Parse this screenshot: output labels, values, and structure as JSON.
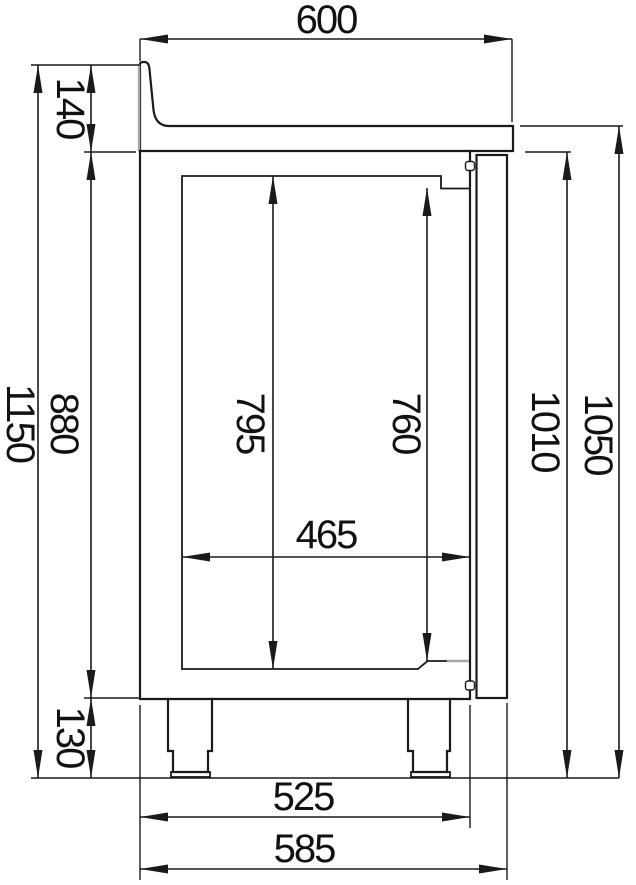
{
  "drawing": {
    "type": "technical-drawing",
    "description": "Side section view of a refrigerated counter with worktop, rear upstand, door and legs",
    "units": "mm",
    "dims": {
      "top_depth": "600",
      "upstand_height": "140",
      "overall_height": "1150",
      "body_height": "880",
      "interior_height_back": "795",
      "interior_height_front": "760",
      "interior_depth": "465",
      "front_height_below_top": "1010",
      "worktop_surface_height": "1050",
      "leg_height": "130",
      "body_depth": "525",
      "overall_depth": "585"
    },
    "colors": {
      "line": "#1a1a1a",
      "light_line": "#a8a8a8",
      "background": "#ffffff"
    }
  }
}
